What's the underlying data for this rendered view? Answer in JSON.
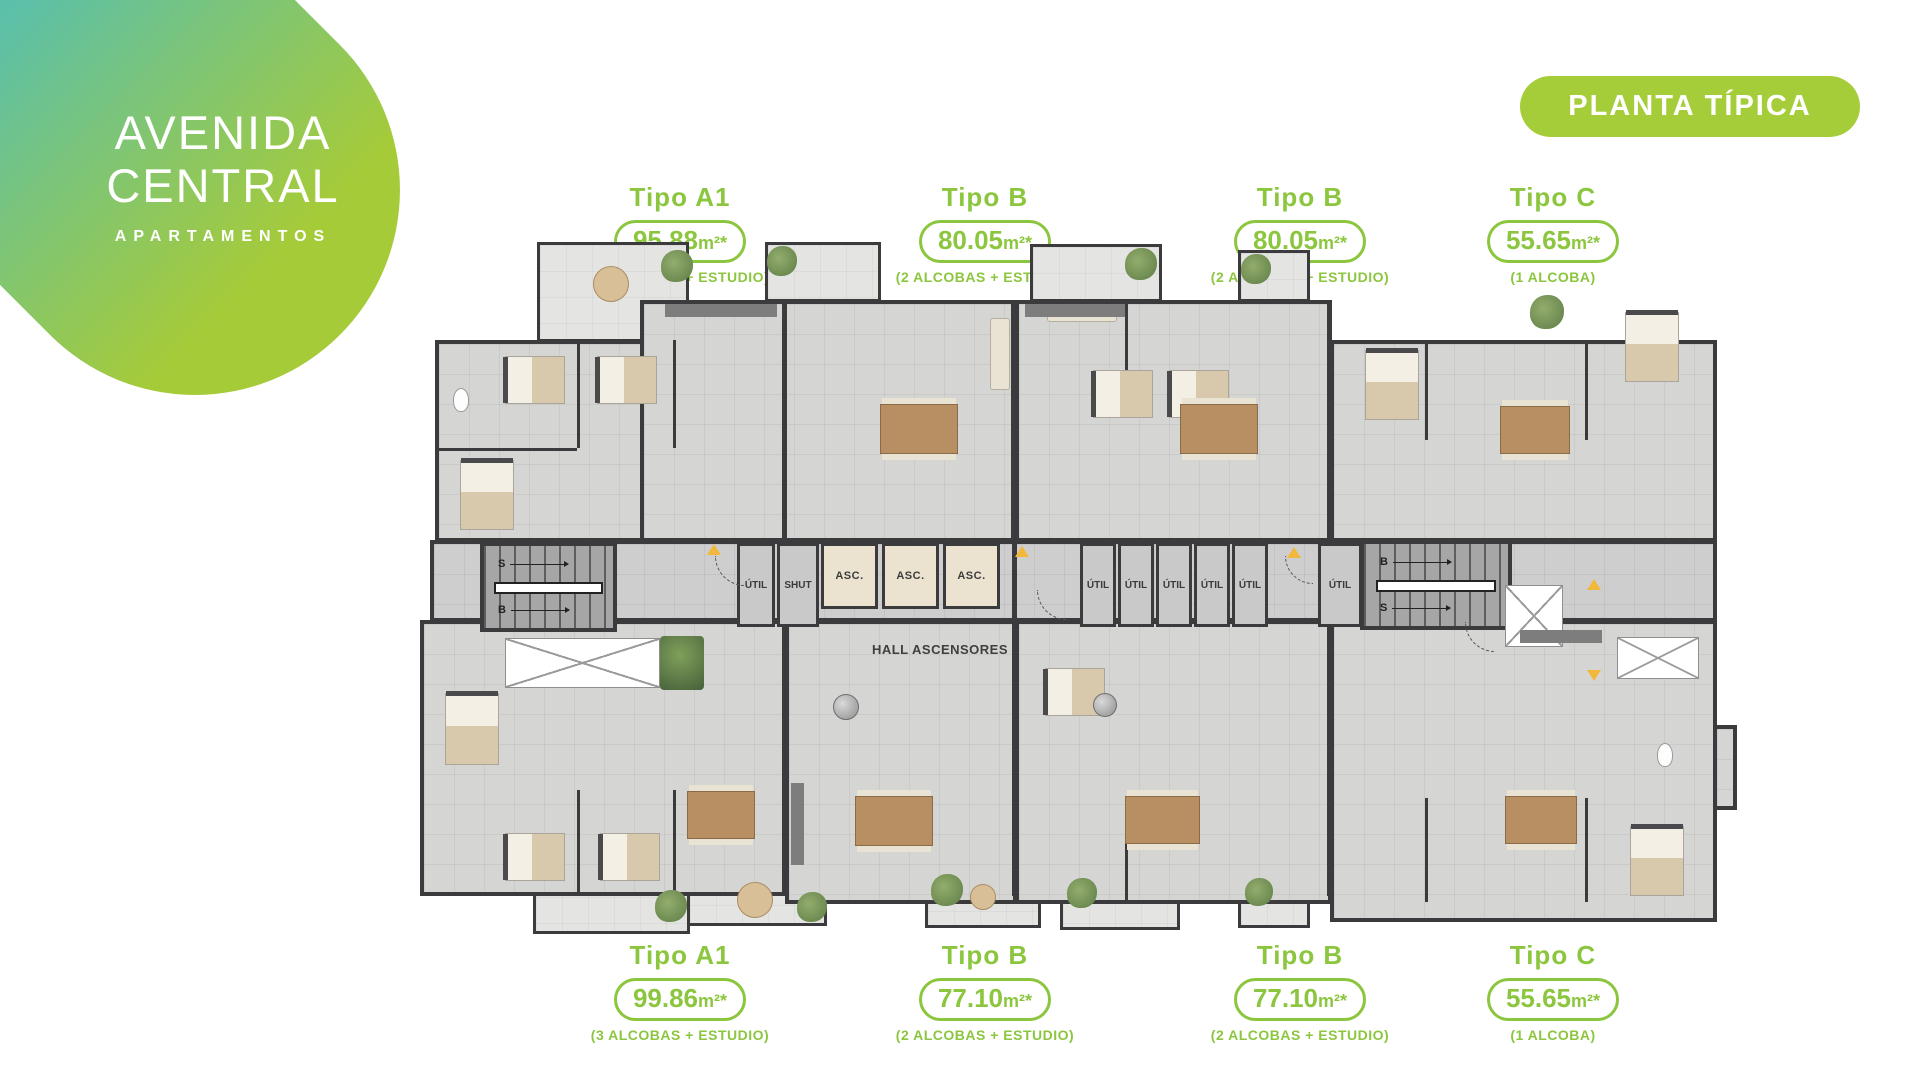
{
  "brand": {
    "line1": "AVENIDA",
    "line2": "CENTRAL",
    "tagline": "APARTAMENTOS"
  },
  "badge": {
    "label": "PLANTA TÍPICA"
  },
  "unit_types": {
    "top": [
      {
        "name": "Tipo A1",
        "area": "95.88",
        "unit": "m²*",
        "detail": "(3 ALCOBAS + ESTUDIO)"
      },
      {
        "name": "Tipo B",
        "area": "80.05",
        "unit": "m²*",
        "detail": "(2 ALCOBAS + ESTUDIO)"
      },
      {
        "name": "Tipo B",
        "area": "80.05",
        "unit": "m²*",
        "detail": "(2 ALCOBAS + ESTUDIO)"
      },
      {
        "name": "Tipo C",
        "area": "55.65",
        "unit": "m²*",
        "detail": "(1 ALCOBA)"
      }
    ],
    "bottom": [
      {
        "name": "Tipo A1",
        "area": "99.86",
        "unit": "m²*",
        "detail": "(3 ALCOBAS + ESTUDIO)"
      },
      {
        "name": "Tipo B",
        "area": "77.10",
        "unit": "m²*",
        "detail": "(2 ALCOBAS + ESTUDIO)"
      },
      {
        "name": "Tipo B",
        "area": "77.10",
        "unit": "m²*",
        "detail": "(2 ALCOBAS + ESTUDIO)"
      },
      {
        "name": "Tipo C",
        "area": "55.65",
        "unit": "m²*",
        "detail": "(1 ALCOBA)"
      }
    ]
  },
  "plan": {
    "hall_label": "HALL ASCENSORES",
    "elevator_label": "ASC.",
    "shut_label": "SHUT",
    "util_label": "ÚTIL",
    "stair_s": "S",
    "stair_b": "B"
  },
  "colors": {
    "accent_green": "#8cc63f",
    "badge_green": "#a5cd39",
    "logo_cyan": "#2bb8dc",
    "logo_lime": "#a6cb39",
    "wall": "#3b3b3d",
    "floor": "#d5d5d4",
    "marker_yellow": "#f2b83c"
  }
}
